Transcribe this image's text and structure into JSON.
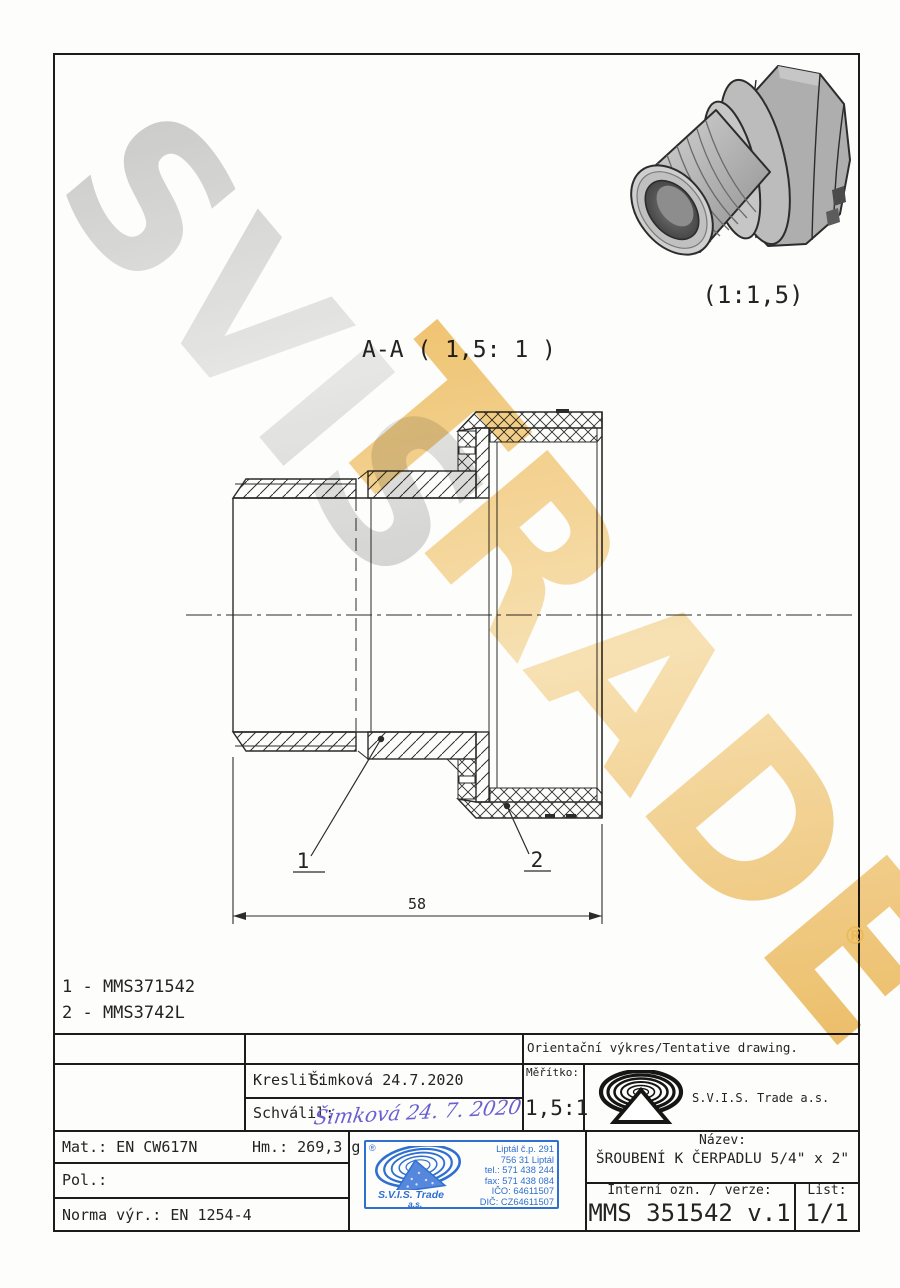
{
  "watermark": {
    "word1": "SVIS",
    "word2": "TRADE",
    "registered": "®",
    "grey_color": "#c9c9c9",
    "gold_color": "#ecba55"
  },
  "views": {
    "section_title": "A-A ( 1,5: 1 )",
    "iso_scale_label": "(1:1,5)",
    "dim_58": "58",
    "balloon_1": "1",
    "balloon_2": "2"
  },
  "part_list": [
    "1 - MMS371542",
    "2 - MMS3742L"
  ],
  "title_block": {
    "tentative": "Orientační výkres/Tentative drawing.",
    "kreslil_label": "Kreslil:",
    "kreslil_value": "Šimková 24.7.2020",
    "schvalil_label": "Schválil:",
    "schvalil_signature": "Šimková 24. 7. 2020",
    "meritko_label": "Měřítko:",
    "meritko_value": "1,5:1",
    "company": "S.V.I.S. Trade a.s.",
    "mat": "Mat.: EN CW617N",
    "hm": "Hm.: 269,3 g",
    "pol": "Pol.:",
    "norma": "Norma výr.: EN 1254-4",
    "nazev_label": "Název:",
    "nazev_value": "ŠROUBENÍ K ČERPADLU 5/4\" x 2\"",
    "interni_label": "Interní ozn. / verze:",
    "interni_value": "MMS 351542 v.1",
    "list_label": "List:",
    "list_value": "1/1"
  },
  "stamp": {
    "registered": "®",
    "company_line1": "S.V.I.S. Trade",
    "company_line2": "a.s.",
    "address": [
      "Liptál č.p. 291",
      "756 31 Liptál",
      "tel.: 571 438 244",
      "fax: 571 438 084",
      "IČO: 64611507",
      "DIČ: CZ64611507"
    ],
    "blue_color": "#2e6fd0"
  }
}
